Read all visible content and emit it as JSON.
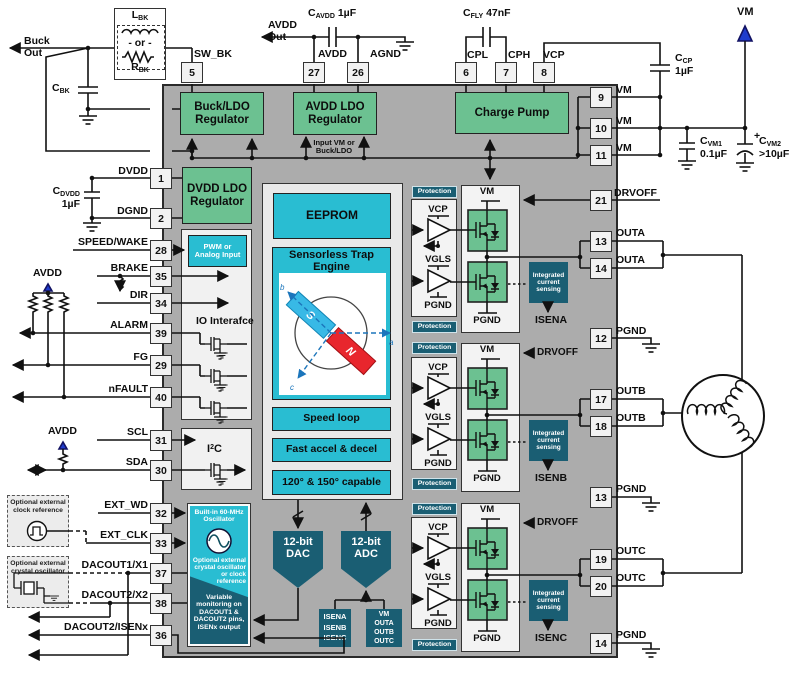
{
  "colors": {
    "green": "#6cc191",
    "cyan": "#29bdd2",
    "teal": "#1a5e73",
    "chip_gray": "#acacac",
    "panel_gray": "#f1f1f1",
    "wire": "#111111",
    "accent_blue": "#1f3ccc",
    "magnet_blue": "#38b9e6",
    "magnet_red": "#e8262d"
  },
  "pins": {
    "top": [
      {
        "num": "5",
        "label": "SW_BK"
      },
      {
        "num": "27",
        "label": "AVDD"
      },
      {
        "num": "26",
        "label": "AGND"
      },
      {
        "num": "6",
        "label": "CPL"
      },
      {
        "num": "7",
        "label": "CPH"
      },
      {
        "num": "8",
        "label": "VCP"
      }
    ],
    "left": [
      {
        "num": "1",
        "label": "DVDD"
      },
      {
        "num": "2",
        "label": "DGND"
      },
      {
        "num": "28",
        "label": "SPEED/WAKE"
      },
      {
        "num": "35",
        "label": "BRAKE"
      },
      {
        "num": "34",
        "label": "DIR"
      },
      {
        "num": "39",
        "label": "ALARM"
      },
      {
        "num": "29",
        "label": "FG"
      },
      {
        "num": "40",
        "label": "nFAULT"
      },
      {
        "num": "31",
        "label": "SCL"
      },
      {
        "num": "30",
        "label": "SDA"
      },
      {
        "num": "32",
        "label": "EXT_WD"
      },
      {
        "num": "33",
        "label": "EXT_CLK"
      },
      {
        "num": "37",
        "label": "DACOUT1/X1"
      },
      {
        "num": "38",
        "label": "DACOUT2/X2"
      },
      {
        "num": "36",
        "label": "DACOUT2/ISENx"
      }
    ],
    "right": [
      {
        "num": "9",
        "label": "VM"
      },
      {
        "num": "10",
        "label": "VM"
      },
      {
        "num": "11",
        "label": "VM"
      },
      {
        "num": "21",
        "label": "DRVOFF"
      },
      {
        "num": "13",
        "label": "OUTA"
      },
      {
        "num": "14",
        "label": "OUTA"
      },
      {
        "num": "12",
        "label": "PGND"
      },
      {
        "num": "17",
        "label": "OUTB"
      },
      {
        "num": "18",
        "label": "OUTB"
      },
      {
        "num": "13",
        "label": "PGND"
      },
      {
        "num": "19",
        "label": "OUTC"
      },
      {
        "num": "20",
        "label": "OUTC"
      },
      {
        "num": "14",
        "label": "PGND"
      }
    ]
  },
  "regulators": {
    "buck": "Buck/LDO Regulator",
    "avdd": "AVDD LDO Regulator",
    "charge_pump": "Charge Pump",
    "dvdd": "DVDD LDO Regulator",
    "input_note": "Input VM or Buck/LDO"
  },
  "core": {
    "eeprom": "EEPROM",
    "trap_engine": "Sensorless Trap Engine",
    "speed": "Speed loop",
    "accel": "Fast accel & decel",
    "capable": "120° & 150° capable",
    "magnet": {
      "s": "S",
      "n": "N"
    },
    "axes": {
      "a": "a",
      "b": "b",
      "c": "c"
    }
  },
  "io": {
    "pwm": "PWM or Analog Input",
    "title": "IO Interafce",
    "i2c": {
      "pre": "I",
      "sup": "2",
      "post": "C"
    }
  },
  "osc": {
    "title": "Built-in 60-MHz Oscillator",
    "mid": "Optional external crystal oscillator or clock reference",
    "bottom": "Variable monitoring on DACOUT1 & DACOUT2 pins, ISENx output"
  },
  "converters": {
    "dac": "12-bit DAC",
    "adc": "12-bit ADC",
    "isen_inputs": [
      "ISENA",
      "ISENB",
      "ISENC"
    ],
    "vm_inputs": [
      "VM",
      "OUTA",
      "OUTB",
      "OUTC"
    ]
  },
  "stages": {
    "protection": "Protection",
    "vm": "VM",
    "vcp": "VCP",
    "vgls": "VGLS",
    "pgnd": "PGND",
    "ics": "Integrated current sensing",
    "drvoff": "DRVOFF",
    "isen": [
      "ISENA",
      "ISENB",
      "ISENC"
    ]
  },
  "external": {
    "buck_out": [
      "Buck",
      "Out"
    ],
    "avdd_out": [
      "AVDD",
      "Out"
    ],
    "vm": "VM",
    "avdd": "AVDD",
    "plus": "+",
    "l_bk": {
      "pre": "L",
      "sub": "BK"
    },
    "r_bk": {
      "pre": "R",
      "sub": "BK"
    },
    "or_label": "- or -",
    "c_bk": {
      "pre": "C",
      "sub": "BK"
    },
    "c_dvdd": {
      "pre": "C",
      "sub": "DVDD",
      "val": "1µF"
    },
    "c_avdd": {
      "pre": "C",
      "sub": "AVDD",
      "val": "1µF"
    },
    "c_fly": {
      "pre": "C",
      "sub": "FLY",
      "val": "47nF"
    },
    "c_cp": {
      "pre": "C",
      "sub": "CP",
      "val": "1µF"
    },
    "c_vm1": {
      "pre": "C",
      "sub": "VM1",
      "val": "0.1µF"
    },
    "c_vm2": {
      "pre": "C",
      "sub": "VM2",
      "val": ">10µF"
    },
    "clock_box": "Optional external clock reference",
    "crystal_box": "Optional external crystal oscillator"
  }
}
